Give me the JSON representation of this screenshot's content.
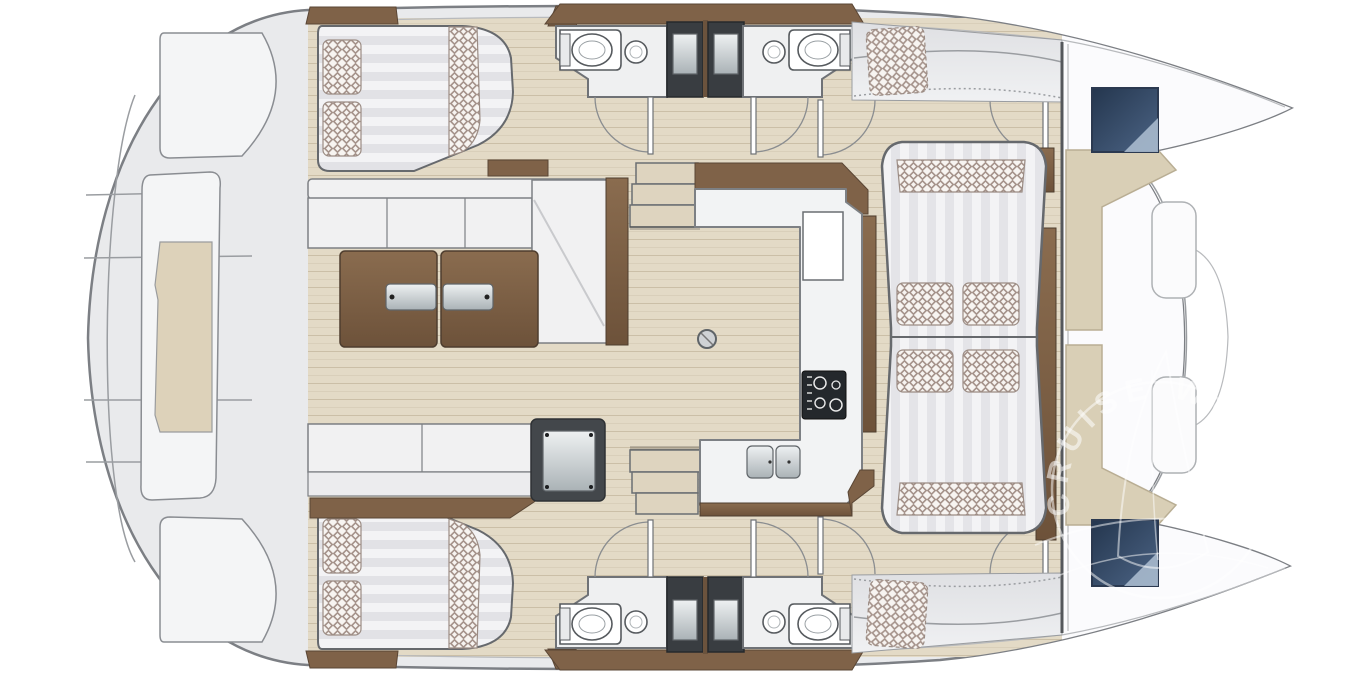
{
  "diagram": {
    "kind": "catamaran-interior-floor-plan",
    "orientation": "bow-right",
    "watermark": {
      "ring_text": "CRUISE WORLD",
      "logo": "sailboat-in-circle-icon",
      "color": "#ffffff"
    },
    "features": [
      {
        "name": "swim-platform",
        "area": "stern"
      },
      {
        "name": "transom-bench",
        "area": "stern-center"
      },
      {
        "name": "double-bed-with-checkered-pillows",
        "area": "port-aft-cabin"
      },
      {
        "name": "double-bed-with-checkered-pillows",
        "area": "starboard-aft-cabin"
      },
      {
        "name": "l-shaped-sofa",
        "area": "saloon"
      },
      {
        "name": "folding-table-two-leaves",
        "area": "saloon"
      },
      {
        "name": "bench-seat",
        "area": "saloon"
      },
      {
        "name": "fridge-module",
        "area": "saloon"
      },
      {
        "name": "staircase-3-steps",
        "area": "saloon-to-port-hull"
      },
      {
        "name": "staircase-3-steps",
        "area": "saloon-to-starboard-hull"
      },
      {
        "name": "u-shaped-galley-counter",
        "area": "galley"
      },
      {
        "name": "stove-cooktop",
        "area": "galley"
      },
      {
        "name": "double-sink",
        "area": "galley"
      },
      {
        "name": "toilet",
        "area": "port-aft-head"
      },
      {
        "name": "toilet",
        "area": "port-forward-head"
      },
      {
        "name": "toilet",
        "area": "starboard-aft-head"
      },
      {
        "name": "toilet",
        "area": "starboard-forward-head"
      },
      {
        "name": "round-washbasin",
        "count": 4
      },
      {
        "name": "shower-stall",
        "count": 4
      },
      {
        "name": "hinged-door-with-swing-arc",
        "count": 8
      },
      {
        "name": "striped-lounge-daybed-with-4-checkered-cushions",
        "area": "forward-saloon"
      },
      {
        "name": "checkered-helm-pad-dashed",
        "count": 2
      },
      {
        "name": "deck-hatch-blue",
        "area": "port-bow"
      },
      {
        "name": "deck-hatch-blue",
        "area": "starboard-bow"
      },
      {
        "name": "beige-l-bench",
        "area": "forward-cockpit",
        "count": 2
      }
    ]
  },
  "colors": {
    "bg": "#ffffff",
    "deck": "#e9eaec",
    "deck_line": "#9a9da1",
    "hull_stroke": "#7c7f84",
    "floor": "#e3dac6",
    "wood": "#7f6248",
    "wood_dark": "#5a4635",
    "counter": "#f2f3f4",
    "counter_stroke": "#7d8084",
    "upholstery": "#f1f1f2",
    "check": "#a5938b",
    "shower": "#393d41",
    "stove": "#24282c",
    "hatch_dark": "#2e3f55",
    "hatch_light": "#9db3c9",
    "bench_beige": "#d9cfb6",
    "forward_deck": "#fbfbfd",
    "watermark": "#ffffff"
  }
}
